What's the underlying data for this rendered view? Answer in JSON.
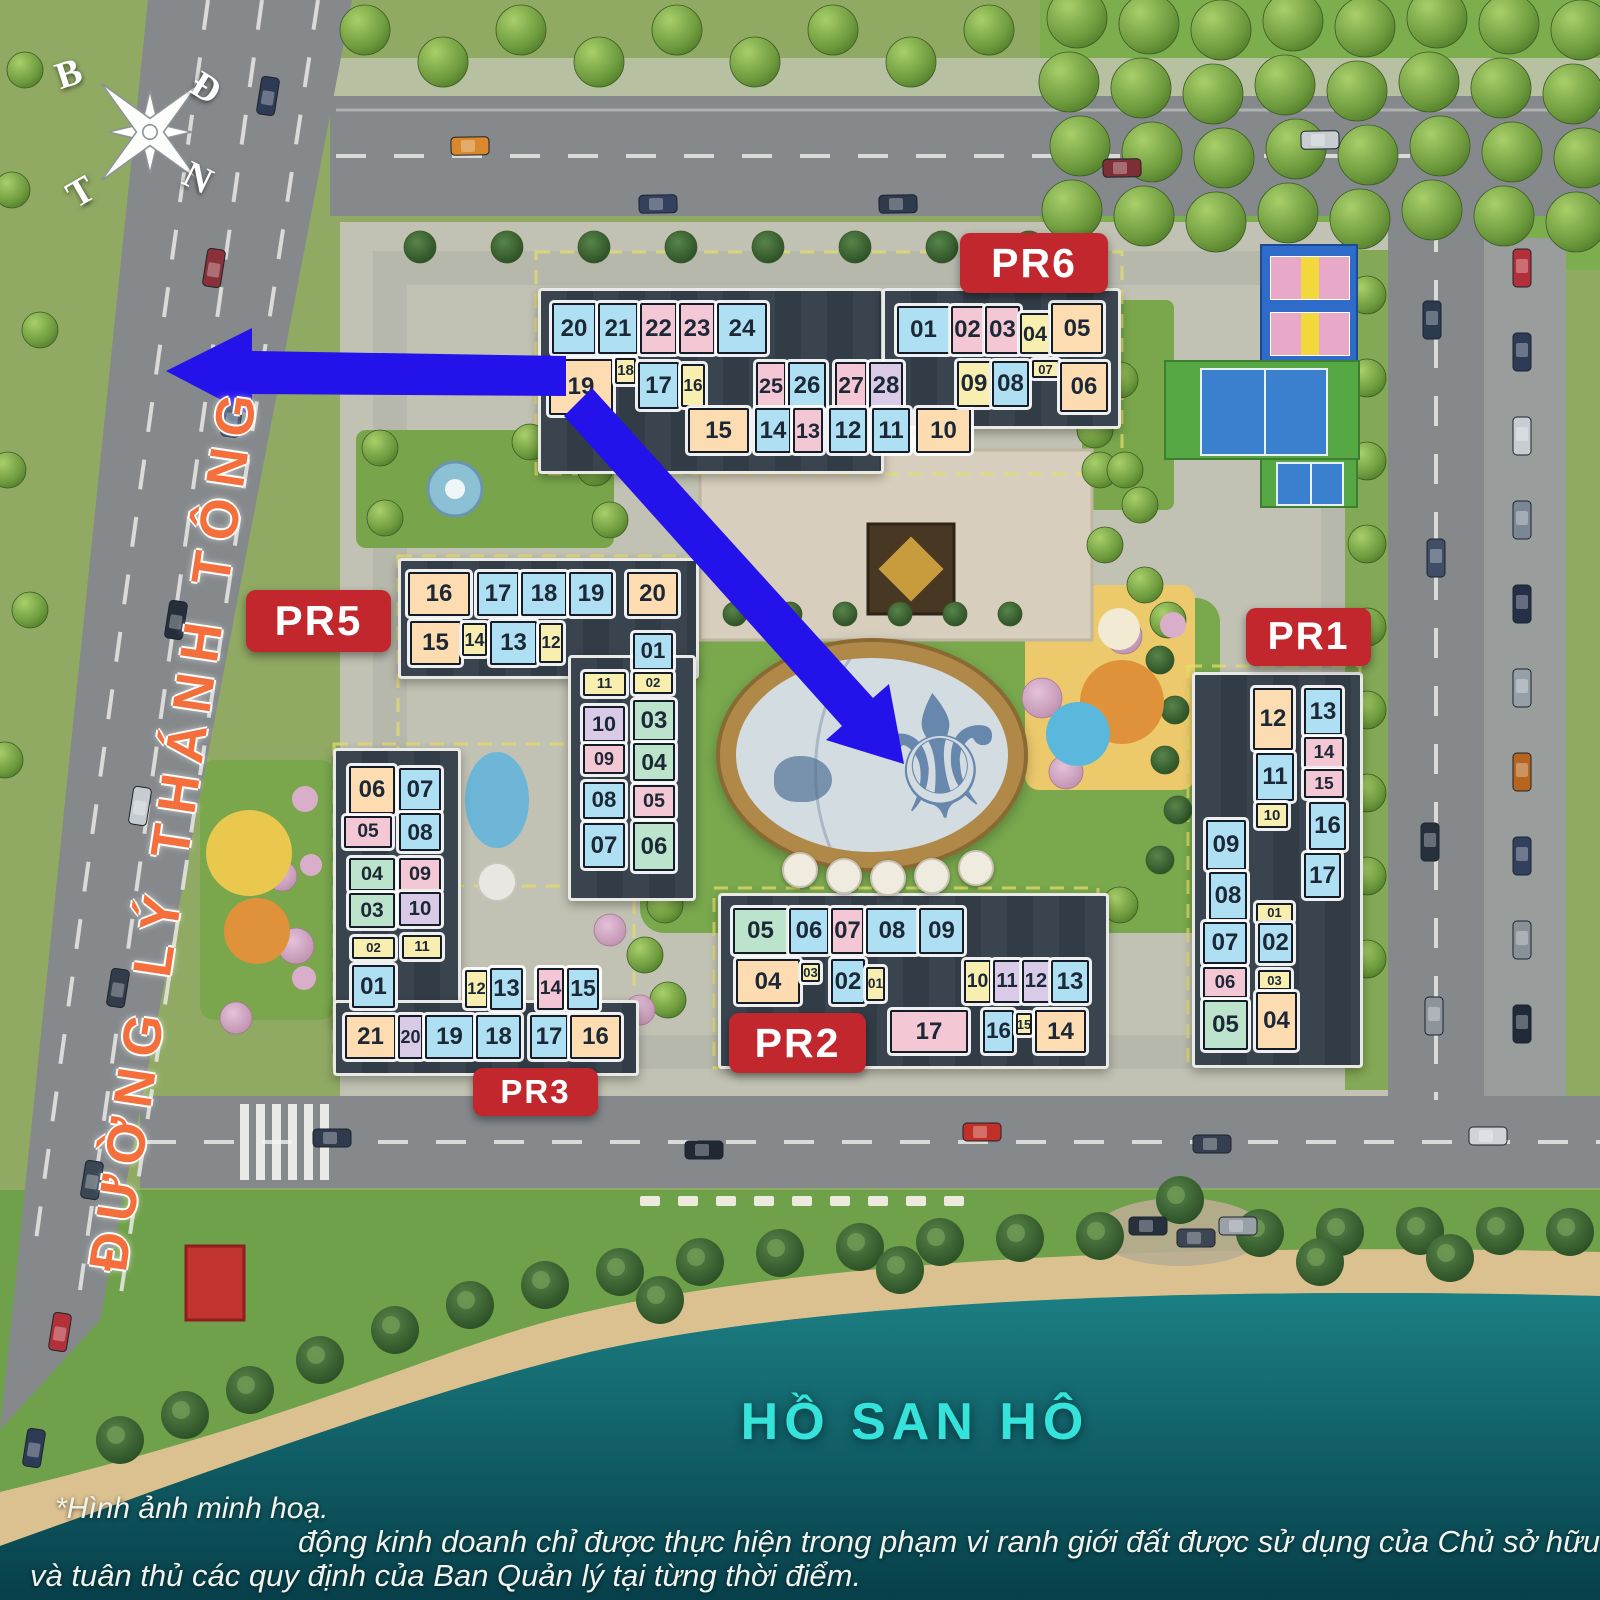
{
  "compass": {
    "north": "B",
    "east": "Đ",
    "west": "T",
    "south": "N"
  },
  "labels": {
    "road": "ĐƯỜNG LÝ THÁNH TÔNG",
    "lake": "HỒ SAN HÔ"
  },
  "disclaimer": {
    "line1": "*Hình ảnh minh hoạ.",
    "line2": "động kinh doanh chỉ được thực hiện trong phạm vi ranh giới đất được sử dụng của Chủ sở hữu nhà/công trình",
    "line3": "và tuân thủ các quy định của Ban Quản lý tại từng thời điểm."
  },
  "palette": {
    "blue": "#aedff2",
    "pink": "#f4c7d4",
    "peach": "#fcdcb0",
    "yellow": "#f8eeb0",
    "green": "#bce3cb",
    "purple": "#d9cbe8"
  },
  "badge_color": "#c1272d",
  "arrow_color": "#2312ea",
  "buildings": [
    {
      "id": "PR6",
      "label": "PR6",
      "badge": {
        "x": 960,
        "y": 233,
        "w": 148,
        "h": 60
      },
      "units": [
        [
          "20",
          "blue",
          552,
          303,
          44,
          51
        ],
        [
          "21",
          "blue",
          598,
          303,
          40,
          51
        ],
        [
          "22",
          "pink",
          640,
          303,
          37,
          51
        ],
        [
          "23",
          "pink",
          679,
          303,
          36,
          51
        ],
        [
          "24",
          "blue",
          717,
          303,
          50,
          51
        ],
        [
          "19",
          "peach",
          549,
          359,
          64,
          56
        ],
        [
          "18",
          "yellow",
          615,
          358,
          21,
          26
        ],
        [
          "17",
          "blue",
          638,
          362,
          41,
          47
        ],
        [
          "16",
          "yellow",
          681,
          364,
          24,
          43
        ],
        [
          "25",
          "pink",
          756,
          362,
          30,
          47
        ],
        [
          "26",
          "blue",
          788,
          362,
          38,
          47
        ],
        [
          "27",
          "pink",
          835,
          362,
          32,
          47
        ],
        [
          "28",
          "purple",
          869,
          362,
          34,
          47
        ],
        [
          "15",
          "peach",
          688,
          408,
          61,
          45
        ],
        [
          "14",
          "blue",
          755,
          408,
          36,
          45
        ],
        [
          "13",
          "pink",
          793,
          408,
          30,
          45
        ],
        [
          "12",
          "blue",
          829,
          408,
          38,
          45
        ],
        [
          "11",
          "blue",
          872,
          408,
          38,
          45
        ],
        [
          "10",
          "peach",
          916,
          408,
          55,
          45
        ],
        [
          "01",
          "blue",
          897,
          306,
          53,
          48
        ],
        [
          "02",
          "pink",
          951,
          306,
          33,
          48
        ],
        [
          "03",
          "pink",
          985,
          306,
          35,
          48
        ],
        [
          "04",
          "yellow",
          1020,
          313,
          30,
          41
        ],
        [
          "05",
          "peach",
          1051,
          303,
          52,
          51
        ],
        [
          "09",
          "yellow",
          957,
          361,
          34,
          46
        ],
        [
          "08",
          "blue",
          992,
          361,
          37,
          46
        ],
        [
          "07",
          "yellow",
          1032,
          360,
          27,
          18
        ],
        [
          "06",
          "peach",
          1060,
          362,
          48,
          50
        ]
      ]
    },
    {
      "id": "PR5",
      "label": "PR5",
      "badge": {
        "x": 246,
        "y": 590,
        "w": 145,
        "h": 62
      },
      "units": [
        [
          "16",
          "peach",
          408,
          572,
          62,
          44
        ],
        [
          "17",
          "blue",
          477,
          572,
          42,
          44
        ],
        [
          "18",
          "blue",
          521,
          572,
          46,
          44
        ],
        [
          "19",
          "blue",
          569,
          572,
          44,
          44
        ],
        [
          "20",
          "peach",
          627,
          572,
          51,
          44
        ],
        [
          "15",
          "peach",
          410,
          621,
          51,
          44
        ],
        [
          "14",
          "yellow",
          462,
          623,
          25,
          33
        ],
        [
          "13",
          "blue",
          490,
          621,
          47,
          44
        ],
        [
          "12",
          "yellow",
          539,
          623,
          24,
          40
        ],
        [
          "11",
          "yellow",
          583,
          672,
          43,
          24
        ],
        [
          "10",
          "purple",
          583,
          706,
          42,
          36
        ],
        [
          "09",
          "pink",
          583,
          744,
          42,
          30
        ],
        [
          "08",
          "blue",
          583,
          782,
          42,
          37
        ],
        [
          "07",
          "blue",
          583,
          823,
          42,
          45
        ],
        [
          "01",
          "blue",
          633,
          633,
          40,
          37
        ],
        [
          "02",
          "yellow",
          633,
          672,
          40,
          22
        ],
        [
          "03",
          "green",
          633,
          700,
          42,
          41
        ],
        [
          "04",
          "green",
          633,
          743,
          42,
          38
        ],
        [
          "05",
          "pink",
          633,
          785,
          42,
          33
        ],
        [
          "06",
          "green",
          633,
          822,
          42,
          49
        ]
      ]
    },
    {
      "id": "PR3",
      "label": "PR3",
      "badge": {
        "x": 473,
        "y": 1068,
        "w": 125,
        "h": 48
      },
      "units": [
        [
          "06",
          "peach",
          349,
          766,
          46,
          48
        ],
        [
          "05",
          "pink",
          344,
          816,
          48,
          32
        ],
        [
          "04",
          "green",
          349,
          858,
          46,
          33
        ],
        [
          "03",
          "green",
          349,
          893,
          46,
          35
        ],
        [
          "02",
          "yellow",
          352,
          937,
          43,
          22
        ],
        [
          "01",
          "blue",
          352,
          965,
          43,
          43
        ],
        [
          "07",
          "blue",
          399,
          768,
          42,
          43
        ],
        [
          "08",
          "blue",
          399,
          813,
          42,
          38
        ],
        [
          "09",
          "pink",
          399,
          858,
          42,
          33
        ],
        [
          "10",
          "purple",
          399,
          892,
          42,
          34
        ],
        [
          "11",
          "yellow",
          402,
          935,
          40,
          24
        ],
        [
          "12",
          "yellow",
          465,
          970,
          23,
          38
        ],
        [
          "13",
          "blue",
          490,
          968,
          33,
          42
        ],
        [
          "14",
          "pink",
          537,
          968,
          27,
          42
        ],
        [
          "15",
          "blue",
          567,
          968,
          32,
          42
        ],
        [
          "21",
          "peach",
          345,
          1015,
          51,
          44
        ],
        [
          "20",
          "purple",
          398,
          1015,
          25,
          44
        ],
        [
          "19",
          "blue",
          425,
          1015,
          49,
          44
        ],
        [
          "18",
          "blue",
          476,
          1015,
          45,
          44
        ],
        [
          "17",
          "blue",
          530,
          1015,
          38,
          44
        ],
        [
          "16",
          "peach",
          570,
          1015,
          51,
          44
        ]
      ]
    },
    {
      "id": "PR2",
      "label": "PR2",
      "badge": {
        "x": 729,
        "y": 1013,
        "w": 137,
        "h": 60
      },
      "units": [
        [
          "05",
          "green",
          733,
          908,
          55,
          46
        ],
        [
          "06",
          "blue",
          789,
          908,
          40,
          46
        ],
        [
          "07",
          "pink",
          831,
          908,
          33,
          46
        ],
        [
          "08",
          "blue",
          866,
          908,
          52,
          46
        ],
        [
          "09",
          "blue",
          919,
          908,
          45,
          46
        ],
        [
          "04",
          "peach",
          736,
          959,
          64,
          45
        ],
        [
          "03",
          "yellow",
          801,
          963,
          19,
          19
        ],
        [
          "02",
          "blue",
          831,
          959,
          34,
          45
        ],
        [
          "01",
          "yellow",
          866,
          967,
          19,
          34
        ],
        [
          "10",
          "yellow",
          964,
          960,
          27,
          43
        ],
        [
          "11",
          "purple",
          993,
          960,
          28,
          43
        ],
        [
          "12",
          "purple",
          1022,
          960,
          28,
          43
        ],
        [
          "13",
          "blue",
          1051,
          960,
          38,
          43
        ],
        [
          "17",
          "pink",
          890,
          1010,
          78,
          43
        ],
        [
          "16",
          "blue",
          983,
          1010,
          31,
          43
        ],
        [
          "15",
          "yellow",
          1016,
          1013,
          16,
          22
        ],
        [
          "14",
          "peach",
          1035,
          1010,
          51,
          43
        ]
      ]
    },
    {
      "id": "PR1",
      "label": "PR1",
      "badge": {
        "x": 1246,
        "y": 608,
        "w": 125,
        "h": 58
      },
      "units": [
        [
          "12",
          "peach",
          1253,
          688,
          40,
          62
        ],
        [
          "11",
          "blue",
          1256,
          753,
          38,
          48
        ],
        [
          "10",
          "yellow",
          1256,
          803,
          32,
          25
        ],
        [
          "09",
          "blue",
          1206,
          820,
          40,
          50
        ],
        [
          "08",
          "blue",
          1209,
          872,
          38,
          48
        ],
        [
          "07",
          "blue",
          1203,
          922,
          44,
          42
        ],
        [
          "06",
          "pink",
          1203,
          967,
          44,
          31
        ],
        [
          "05",
          "green",
          1203,
          1000,
          45,
          50
        ],
        [
          "13",
          "blue",
          1304,
          688,
          38,
          47
        ],
        [
          "14",
          "pink",
          1304,
          737,
          40,
          31
        ],
        [
          "15",
          "pink",
          1304,
          769,
          40,
          29
        ],
        [
          "16",
          "blue",
          1309,
          802,
          37,
          48
        ],
        [
          "17",
          "blue",
          1304,
          853,
          37,
          45
        ],
        [
          "01",
          "yellow",
          1256,
          903,
          37,
          19
        ],
        [
          "02",
          "blue",
          1258,
          923,
          35,
          40
        ],
        [
          "03",
          "yellow",
          1258,
          970,
          33,
          20
        ],
        [
          "04",
          "peach",
          1256,
          992,
          41,
          58
        ]
      ]
    }
  ]
}
